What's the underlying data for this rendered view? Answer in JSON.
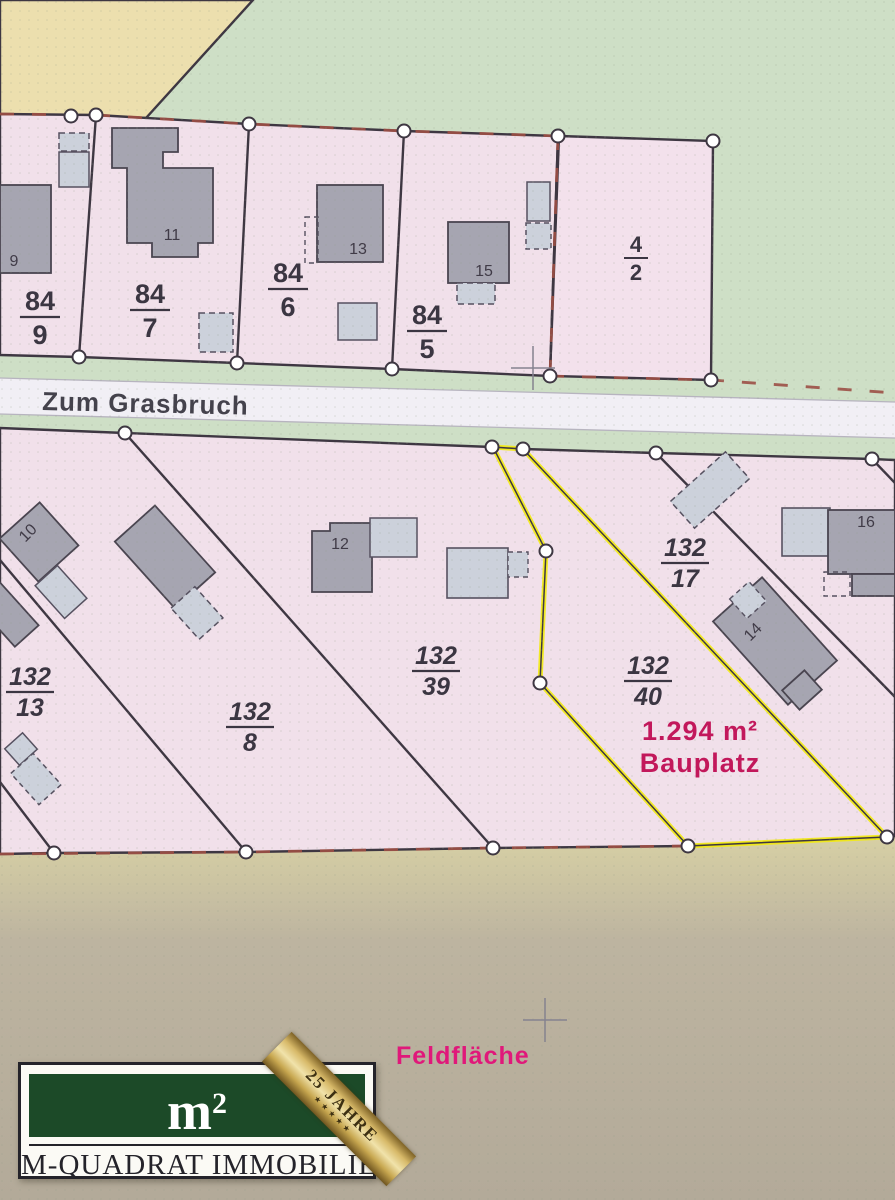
{
  "map": {
    "street_name": "Zum Grasbruch",
    "field_label": "Feldfläche",
    "highlight_area": "1.294 m²",
    "highlight_type": "Bauplatz",
    "colors": {
      "parcel_pink": "#f1e0ea",
      "green_area": "#cedfc6",
      "tan_top": "#ecdfae",
      "field_bottom": "#b5ac9b",
      "road_white": "#f1eff5",
      "boundary_dark": "#3e3742",
      "boundary_accent_red": "#9c4f45",
      "highlight_yellow": "#f2ea15",
      "highlight_text": "#c2185b",
      "field_text": "#e0187a",
      "house_dark": "#a6a5b1",
      "house_light": "#ccd1db",
      "logo_green": "#1c4a28"
    },
    "parcels": [
      {
        "id": "84/9",
        "num": "84",
        "den": "9"
      },
      {
        "id": "84/7",
        "num": "84",
        "den": "7"
      },
      {
        "id": "84/6",
        "num": "84",
        "den": "6"
      },
      {
        "id": "84/5",
        "num": "84",
        "den": "5"
      },
      {
        "id": "4/2",
        "num": "4",
        "den": "2"
      },
      {
        "id": "132/13",
        "num": "132",
        "den": "13"
      },
      {
        "id": "132/8",
        "num": "132",
        "den": "8"
      },
      {
        "id": "132/39",
        "num": "132",
        "den": "39"
      },
      {
        "id": "132/40",
        "num": "132",
        "den": "40"
      },
      {
        "id": "132/17",
        "num": "132",
        "den": "17"
      }
    ],
    "house_numbers": [
      "9",
      "11",
      "13",
      "15",
      "10",
      "12",
      "14",
      "16"
    ]
  },
  "logo": {
    "symbol": "m",
    "superscript": "2",
    "company": "M-QUADRAT IMMOBILIEN",
    "anniversary_number": "25",
    "anniversary_word": "JAHRE",
    "stars": "★★★★★"
  }
}
